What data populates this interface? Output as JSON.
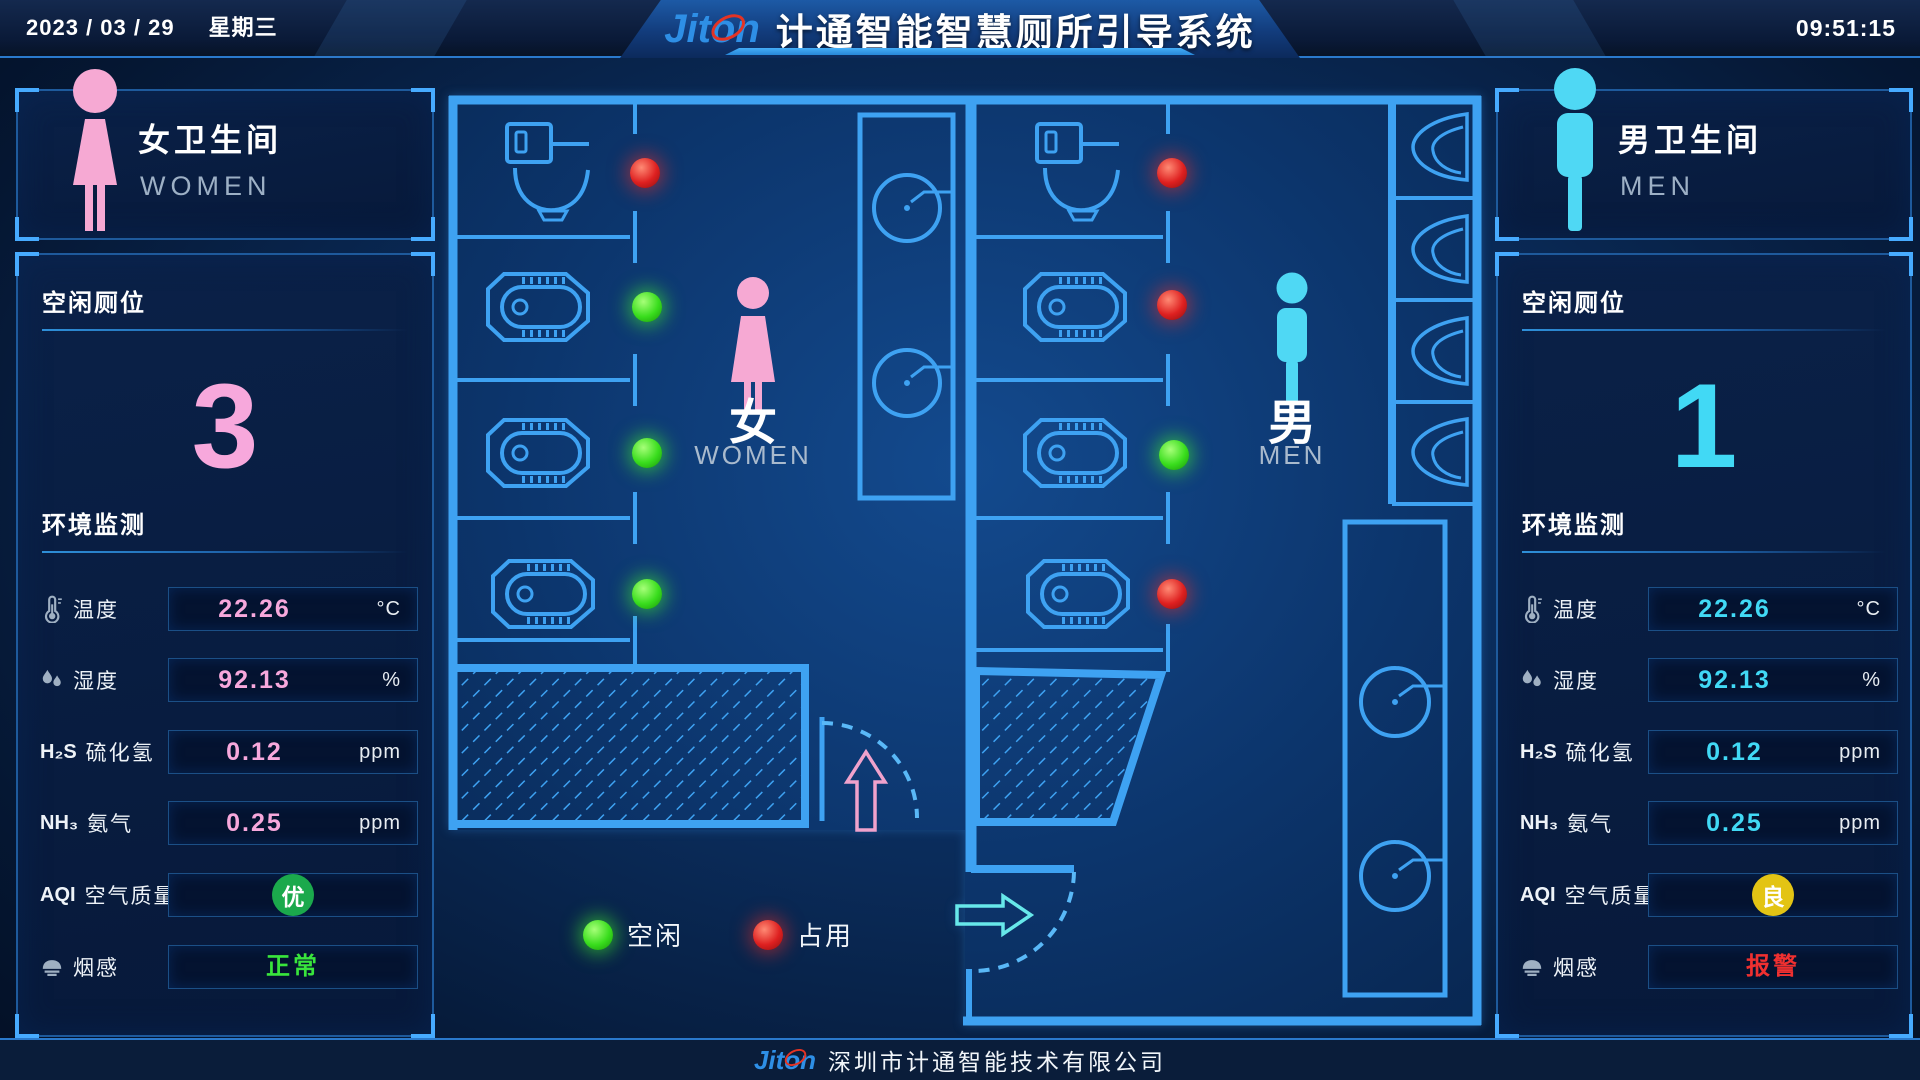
{
  "header": {
    "date": "2023 / 03 / 29",
    "weekday": "星期三",
    "time": "09:51:15",
    "logo": "Jiton",
    "title": "计通智能智慧厕所引导系统"
  },
  "footer": {
    "logo": "Jiton",
    "company": "深圳市计通智能技术有限公司"
  },
  "legend": {
    "free": "空闲",
    "occupied": "占用"
  },
  "plan": {
    "women_label": "女",
    "women_sub": "WOMEN",
    "men_label": "男",
    "men_sub": "MEN",
    "women_stalls": [
      "occupied",
      "free",
      "free",
      "free"
    ],
    "men_stalls": [
      "occupied",
      "occupied",
      "free",
      "occupied"
    ]
  },
  "women": {
    "title": "女卫生间",
    "subtitle": "WOMEN",
    "accent": "#f7a8dc",
    "free_heading": "空闲厕位",
    "free_count": "3",
    "env_heading": "环境监测",
    "temp": {
      "label": "温度",
      "value": "22.26",
      "unit": "°C"
    },
    "hum": {
      "label": "湿度",
      "value": "92.13",
      "unit": "%"
    },
    "h2s": {
      "prefix": "H₂S",
      "label": "硫化氢",
      "value": "0.12",
      "unit": "ppm"
    },
    "nh3": {
      "prefix": "NH₃",
      "label": "氨气",
      "value": "0.25",
      "unit": "ppm"
    },
    "aqi": {
      "prefix": "AQI",
      "label": "空气质量",
      "badge": "优",
      "badge_style": "background:#1ba94c"
    },
    "smoke": {
      "label": "烟感",
      "status": "正常",
      "status_style": "color:#39e53c"
    }
  },
  "men": {
    "title": "男卫生间",
    "subtitle": "MEN",
    "accent": "#41d9f5",
    "free_heading": "空闲厕位",
    "free_count": "1",
    "env_heading": "环境监测",
    "temp": {
      "label": "温度",
      "value": "22.26",
      "unit": "°C"
    },
    "hum": {
      "label": "湿度",
      "value": "92.13",
      "unit": "%"
    },
    "h2s": {
      "prefix": "H₂S",
      "label": "硫化氢",
      "value": "0.12",
      "unit": "ppm"
    },
    "nh3": {
      "prefix": "NH₃",
      "label": "氨气",
      "value": "0.25",
      "unit": "ppm"
    },
    "aqi": {
      "prefix": "AQI",
      "label": "空气质量",
      "badge": "良",
      "badge_style": "background:#e3c414"
    },
    "smoke": {
      "label": "烟感",
      "status": "报警",
      "status_style": "color:#f03030"
    }
  }
}
